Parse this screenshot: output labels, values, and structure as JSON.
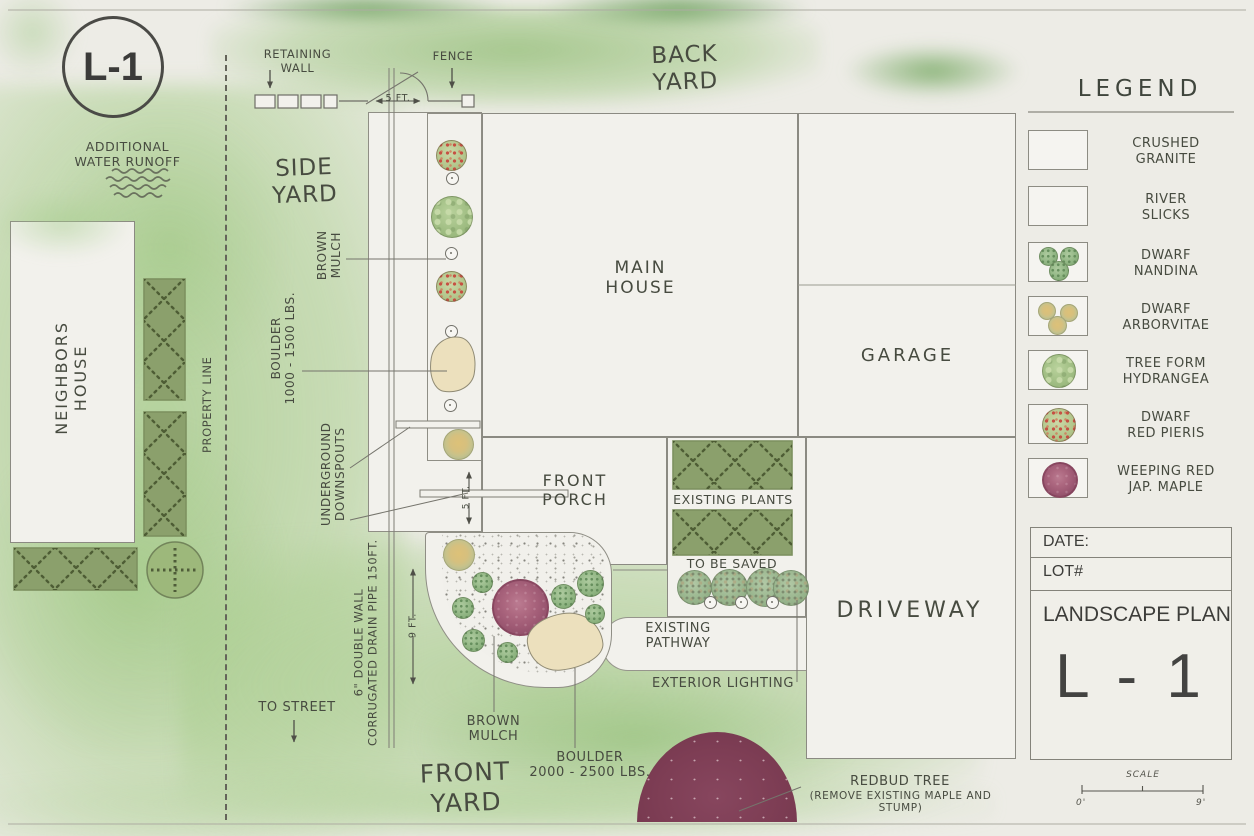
{
  "badge": {
    "label": "L-1"
  },
  "yards": {
    "back": "BACK\nYARD",
    "side": "SIDE\nYARD",
    "front": "FRONT\nYARD"
  },
  "structures": {
    "neighbors_house": "NEIGHBORS\nHOUSE",
    "main_house": "MAIN\nHOUSE",
    "garage": "GARAGE",
    "front_porch": "FRONT\nPORCH",
    "driveway": "DRIVEWAY"
  },
  "site": {
    "property_line": "PROPERTY LINE",
    "retaining_wall": "RETAINING\nWALL",
    "fence": "FENCE",
    "additional_runoff": "ADDITIONAL\nWATER RUNOFF",
    "to_street": "TO STREET",
    "existing_plants": "EXISTING PLANTS",
    "to_be_saved": "TO BE SAVED",
    "existing_pathway": "EXISTING\nPATHWAY",
    "exterior_lighting": "EXTERIOR LIGHTING",
    "redbud_tree": "REDBUD TREE",
    "redbud_note": "(REMOVE EXISTING MAPLE AND STUMP)"
  },
  "side_bed": {
    "brown_mulch": "BROWN\nMULCH",
    "boulder": "BOULDER\n1000 - 1500 LBS.",
    "downspouts": "UNDERGROUND\nDOWNSPOUTS",
    "drain_pipe": "6\" DOUBLE WALL\nCORRUGATED DRAIN PIPE 150FT."
  },
  "front_bed": {
    "brown_mulch": "BROWN\nMULCH",
    "boulder": "BOULDER\n2000 - 2500 LBS."
  },
  "dimensions": {
    "wall_offset": "5 FT.",
    "bed_width_side": "5 FT.",
    "bed_width_front": "9 FT."
  },
  "legend": {
    "title": "LEGEND",
    "items": [
      {
        "id": "crushed-granite",
        "label": "CRUSHED\nGRANITE"
      },
      {
        "id": "river-slicks",
        "label": "RIVER\nSLICKS"
      },
      {
        "id": "dwarf-nandina",
        "label": "DWARF\nNANDINA"
      },
      {
        "id": "dwarf-arborvitae",
        "label": "DWARF\nARBORVITAE"
      },
      {
        "id": "tree-form-hydrangea",
        "label": "TREE FORM\nHYDRANGEA"
      },
      {
        "id": "dwarf-red-pieris",
        "label": "DWARF\nRED PIERIS"
      },
      {
        "id": "weeping-red-jap-maple",
        "label": "WEEPING RED\nJAP. MAPLE"
      }
    ]
  },
  "title_block": {
    "date_label": "DATE:",
    "lot_label": "LOT#",
    "plan_title": "LANDSCAPE PLAN",
    "sheet_number": "L - 1"
  },
  "scale_bar": {
    "label": "SCALE",
    "start": "0'",
    "end": "9'"
  },
  "colors": {
    "paper": "#edece6",
    "wash_green": "#a9cc93",
    "hedge_green": "#8ba06c",
    "maple_rose": "#a05b75",
    "redbud_maroon": "#7d3d54",
    "boulder_tan": "#ece0bd",
    "line_gray": "#75746c"
  }
}
